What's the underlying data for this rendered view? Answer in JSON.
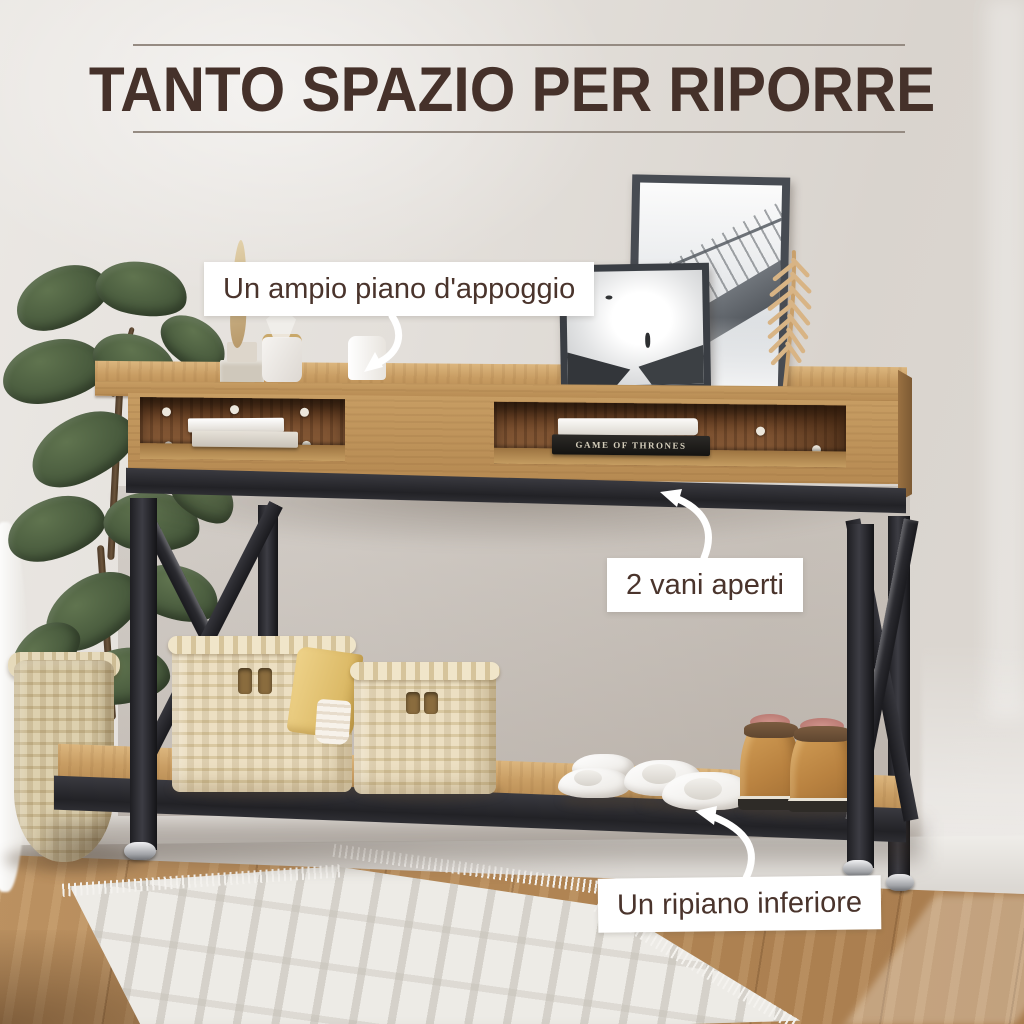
{
  "title": {
    "text": "TANTO SPAZIO PER RIPORRE"
  },
  "callouts": [
    {
      "id": "top-surface",
      "label": "Un ampio piano d'appoggio"
    },
    {
      "id": "open-compartments",
      "label": "2 vani aperti"
    },
    {
      "id": "bottom-shelf",
      "label": "Un ripiano inferiore"
    }
  ],
  "props": {
    "book_spine": "GAME OF THRONES"
  },
  "icons": {
    "arrow_top": "curved-arrow-down-icon",
    "arrow_middle": "curved-arrow-up-icon",
    "arrow_bottom": "curved-arrow-up-icon"
  },
  "colors": {
    "title_text": "#45312a",
    "divider_rule": "#958b82",
    "callout_bg": "#ffffff",
    "callout_text": "#4a342c",
    "arrow": "#ffffff",
    "wall": "#e0dcd7",
    "oak_wood": "#c49a63",
    "walnut_interior": "#7a4f30",
    "metal_frame": "#2a2a2e",
    "floor_wood": "#b28756",
    "rug": "#edebe6"
  }
}
